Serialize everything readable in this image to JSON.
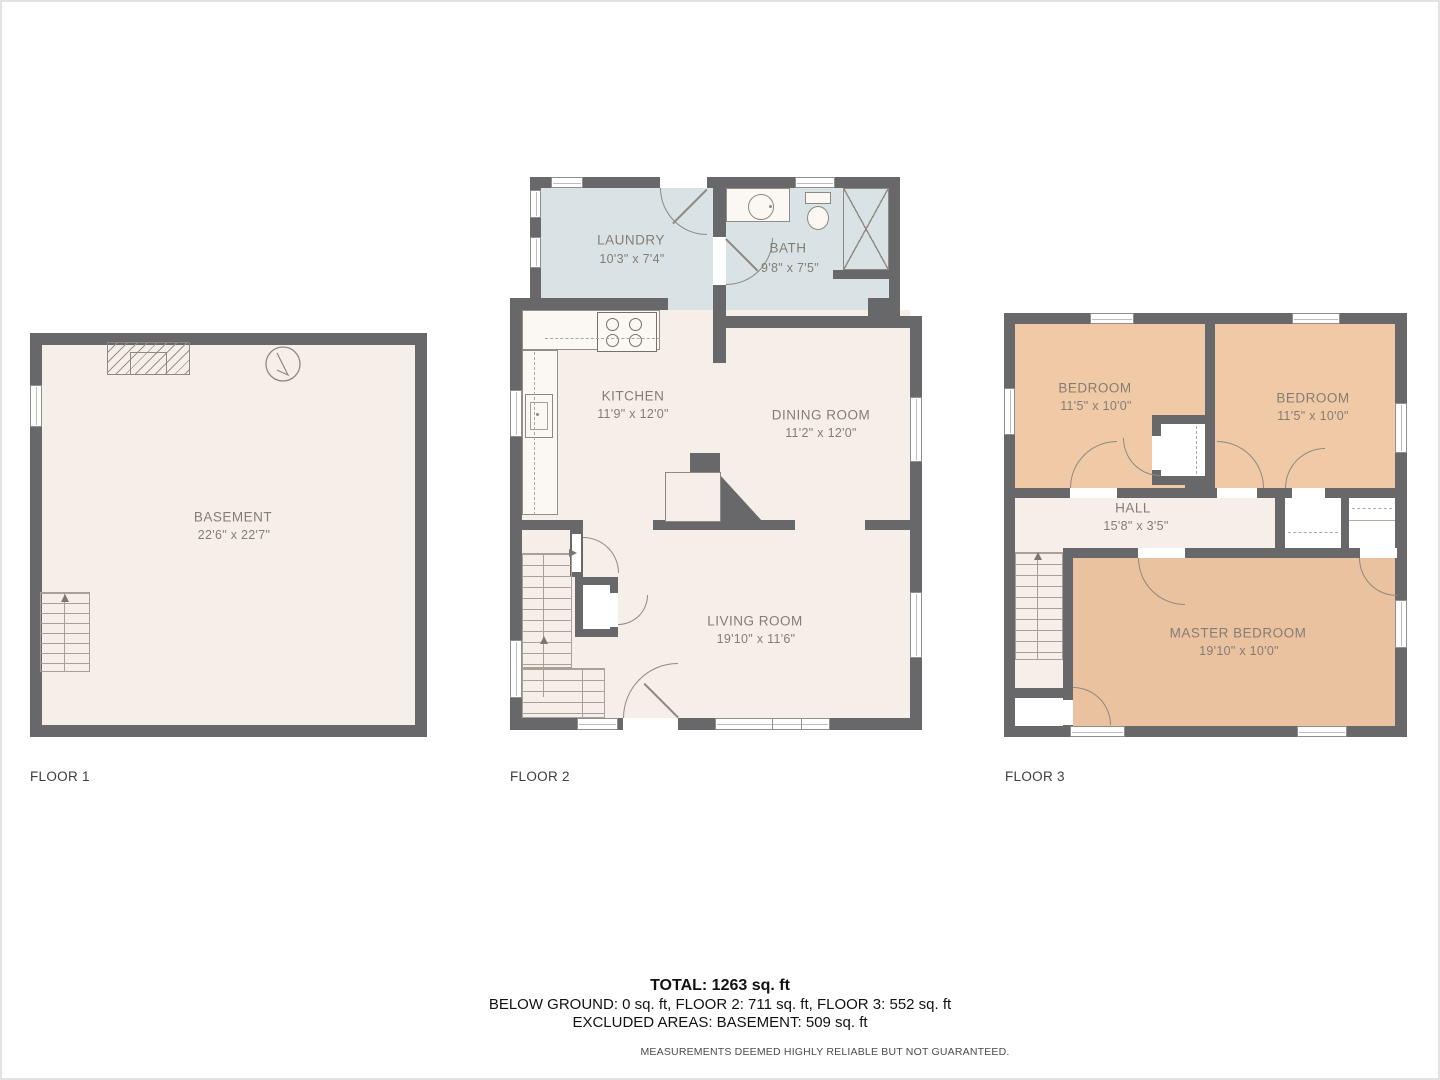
{
  "floors": [
    {
      "label": "FLOOR 1",
      "rooms": [
        {
          "name": "BASEMENT",
          "dims": "22'6\" x 22'7\""
        }
      ]
    },
    {
      "label": "FLOOR 2",
      "rooms": [
        {
          "name": "LAUNDRY",
          "dims": "10'3\" x 7'4\""
        },
        {
          "name": "BATH",
          "dims": "9'8\" x 7'5\""
        },
        {
          "name": "KITCHEN",
          "dims": "11'9\" x 12'0\""
        },
        {
          "name": "DINING ROOM",
          "dims": "11'2\" x 12'0\""
        },
        {
          "name": "LIVING ROOM",
          "dims": "19'10\" x 11'6\""
        }
      ]
    },
    {
      "label": "FLOOR 3",
      "rooms": [
        {
          "name": "BEDROOM",
          "dims": "11'5\" x 10'0\""
        },
        {
          "name": "BEDROOM",
          "dims": "11'5\" x 10'0\""
        },
        {
          "name": "HALL",
          "dims": "15'8\" x 3'5\""
        },
        {
          "name": "MASTER BEDROOM",
          "dims": "19'10\" x 10'0\""
        }
      ]
    }
  ],
  "summary": {
    "total": "TOTAL: 1263 sq. ft",
    "line2": "BELOW GROUND: 0 sq. ft, FLOOR 2: 711 sq. ft, FLOOR 3: 552 sq. ft",
    "line3": "EXCLUDED AREAS: BASEMENT: 509 sq. ft",
    "disclaimer": "MEASUREMENTS DEEMED HIGHLY RELIABLE BUT NOT GUARANTEED."
  },
  "colors": {
    "wall": "#68686a",
    "floor": "#f6efe9",
    "wet_room": "#d9e3e6",
    "bedroom": "#f0caa7",
    "master_bedroom": "#eac2a0"
  }
}
